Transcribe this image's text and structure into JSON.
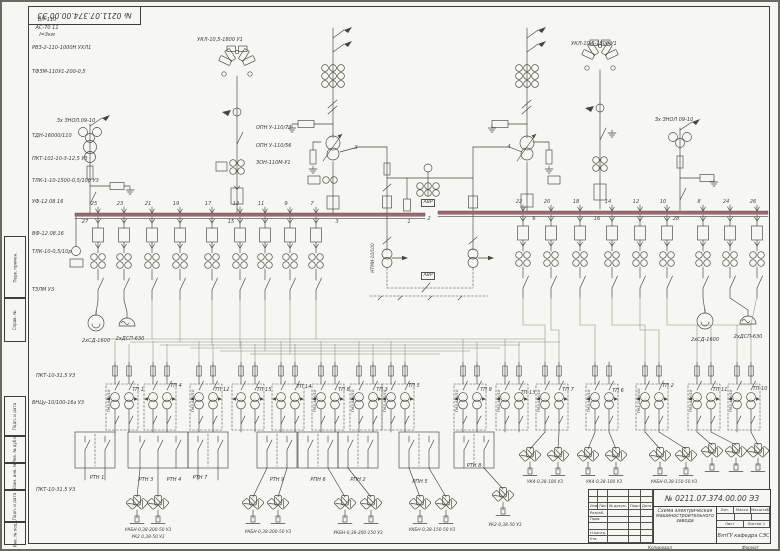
{
  "sheet": {
    "corner_stamp": "№ 0211.07.374.00.00 ЭЗ",
    "margin_labels": [
      {
        "t": "Перв. примен.",
        "y": 236,
        "h": 62
      },
      {
        "t": "Справ. №",
        "y": 298,
        "h": 44
      },
      {
        "t": "Подп. и дата",
        "y": 396,
        "h": 40
      },
      {
        "t": "Инв. № дубл.",
        "y": 436,
        "h": 27
      },
      {
        "t": "Взам. инв. №",
        "y": 463,
        "h": 27
      },
      {
        "t": "Подп. и дата",
        "y": 490,
        "h": 32
      },
      {
        "t": "Инв. № подл.",
        "y": 522,
        "h": 23
      }
    ],
    "title_block": {
      "doc_number": "№ 0211.07.374.00.00 ЭЗ",
      "title": "Схема электрическая машиностроительного завода",
      "org": "ВятГУ кафедра СЭС",
      "header_cells": [
        "Изм.",
        "Лист",
        "№ докум.",
        "Подп.",
        "Дата"
      ],
      "row_labels": [
        "Разраб.",
        "Пров.",
        "",
        "Н.контр.",
        "Утв."
      ],
      "lit_label": "Лит.",
      "mass_label": "Масса",
      "scale_label": "Масштаб",
      "sheet_label": "Лист",
      "sheets_label": "Листов 1",
      "kopiroval": "Копировал",
      "format_label": "Формат"
    }
  },
  "colors": {
    "paper": "#f6f6f2",
    "ink": "#45453f",
    "bus": "#9d6874",
    "routing": "#8e8e86",
    "frame": "#3e3e3a"
  },
  "placed_labels": [
    {
      "t": "ВЛ-110",
      "x": 47,
      "y": 18,
      "a": "c"
    },
    {
      "t": "АС-70 11",
      "x": 47,
      "y": 25.5,
      "a": "c"
    },
    {
      "t": "l=3км",
      "x": 47,
      "y": 33,
      "a": "c"
    },
    {
      "t": "РВЗ-2-110-1000Н УХЛ1",
      "x": 32,
      "y": 46
    },
    {
      "t": "ТФЗМ-110У1-200-0,5",
      "x": 32,
      "y": 70
    },
    {
      "t": "УКЛ-10,5-1800 У1",
      "x": 220,
      "y": 38,
      "a": "c"
    },
    {
      "t": "УКЛ-10,5-1800 У1",
      "x": 594,
      "y": 42,
      "a": "c"
    },
    {
      "t": "Зх ЗНОЛ.09-10",
      "x": 76,
      "y": 119,
      "a": "c"
    },
    {
      "t": "ТДН-16000/110",
      "x": 32,
      "y": 134
    },
    {
      "t": "ПКТ-101-10-3-12,5 У3",
      "x": 32,
      "y": 157
    },
    {
      "t": "ТЛК-1-10-1500-0,5/10р У3",
      "x": 32,
      "y": 179
    },
    {
      "t": "УФ-12.08.16",
      "x": 32,
      "y": 200
    },
    {
      "t": "ВФ-12.08.16",
      "x": 32,
      "y": 232
    },
    {
      "t": "ТЛК-10-0,5/10р",
      "x": 32,
      "y": 250
    },
    {
      "t": "ТЗЛМ У3",
      "x": 32,
      "y": 288
    },
    {
      "t": "ОПН У-110/73",
      "x": 256,
      "y": 126
    },
    {
      "t": "ОПН У-110/56",
      "x": 256,
      "y": 144
    },
    {
      "t": "ЗОН-110М-У1",
      "x": 256,
      "y": 161
    },
    {
      "t": "Зх ЗНОЛ 09-10",
      "x": 674,
      "y": 118,
      "a": "c"
    },
    {
      "t": "2хСД-1600",
      "x": 96,
      "y": 339,
      "a": "c"
    },
    {
      "t": "2хДСП-630",
      "x": 130,
      "y": 337,
      "a": "c"
    },
    {
      "t": "2хСД-1600",
      "x": 705,
      "y": 338,
      "a": "c"
    },
    {
      "t": "2хДСП-630",
      "x": 748,
      "y": 335,
      "a": "c"
    },
    {
      "t": "ПКТ-10-31,5 У3",
      "x": 36,
      "y": 374
    },
    {
      "t": "ВНЦу-10/100-16з У3",
      "x": 32,
      "y": 401
    },
    {
      "t": "ПКТ-10-31,5 У3",
      "x": 36,
      "y": 488
    },
    {
      "t": "АВР",
      "x": 428,
      "y": 199,
      "a": "c",
      "cls": "box",
      "n": "avr-box"
    },
    {
      "t": "АВР",
      "x": 428,
      "y": 272,
      "a": "c",
      "cls": "box",
      "n": "avr-box"
    },
    {
      "t": "НТМИ-10/100",
      "x": 374,
      "y": 258,
      "r": -90,
      "cls": "small"
    },
    {
      "t": "25",
      "x": 94,
      "y": 202,
      "a": "c",
      "cls": "num",
      "n": "feeder-number"
    },
    {
      "t": "23",
      "x": 120,
      "y": 202,
      "a": "c",
      "cls": "num",
      "n": "feeder-number"
    },
    {
      "t": "21",
      "x": 148,
      "y": 202,
      "a": "c",
      "cls": "num",
      "n": "feeder-number"
    },
    {
      "t": "19",
      "x": 176,
      "y": 202,
      "a": "c",
      "cls": "num",
      "n": "feeder-number"
    },
    {
      "t": "17",
      "x": 208,
      "y": 202,
      "a": "c",
      "cls": "num",
      "n": "feeder-number"
    },
    {
      "t": "13",
      "x": 236,
      "y": 202,
      "a": "c",
      "cls": "num",
      "n": "feeder-number"
    },
    {
      "t": "11",
      "x": 261,
      "y": 202,
      "a": "c",
      "cls": "num",
      "n": "feeder-number"
    },
    {
      "t": "9",
      "x": 286,
      "y": 202,
      "a": "c",
      "cls": "num",
      "n": "feeder-number"
    },
    {
      "t": "7",
      "x": 312,
      "y": 202,
      "a": "c",
      "cls": "num",
      "n": "feeder-number"
    },
    {
      "t": "27",
      "x": 85,
      "y": 220,
      "a": "c",
      "cls": "num",
      "n": "feeder-number"
    },
    {
      "t": "15",
      "x": 231,
      "y": 220,
      "a": "c",
      "cls": "num",
      "n": "feeder-number"
    },
    {
      "t": "3",
      "x": 337,
      "y": 220,
      "a": "c",
      "cls": "num",
      "n": "feeder-number"
    },
    {
      "t": "1",
      "x": 409,
      "y": 220,
      "a": "c",
      "cls": "num",
      "n": "section-number"
    },
    {
      "t": "22",
      "x": 519,
      "y": 200,
      "a": "c",
      "cls": "num",
      "n": "feeder-number"
    },
    {
      "t": "20",
      "x": 547,
      "y": 200,
      "a": "c",
      "cls": "num",
      "n": "feeder-number"
    },
    {
      "t": "18",
      "x": 576,
      "y": 200,
      "a": "c",
      "cls": "num",
      "n": "feeder-number"
    },
    {
      "t": "14",
      "x": 608,
      "y": 200,
      "a": "c",
      "cls": "num",
      "n": "feeder-number"
    },
    {
      "t": "12",
      "x": 636,
      "y": 200,
      "a": "c",
      "cls": "num",
      "n": "feeder-number"
    },
    {
      "t": "10",
      "x": 663,
      "y": 200,
      "a": "c",
      "cls": "num",
      "n": "feeder-number"
    },
    {
      "t": "8",
      "x": 699,
      "y": 200,
      "a": "c",
      "cls": "num",
      "n": "feeder-number"
    },
    {
      "t": "24",
      "x": 726,
      "y": 200,
      "a": "c",
      "cls": "num",
      "n": "feeder-number"
    },
    {
      "t": "26",
      "x": 753,
      "y": 200,
      "a": "c",
      "cls": "num",
      "n": "feeder-number"
    },
    {
      "t": "2",
      "x": 429,
      "y": 217,
      "a": "c",
      "cls": "num",
      "n": "section-number"
    },
    {
      "t": "6",
      "x": 534,
      "y": 217,
      "a": "c",
      "cls": "num",
      "n": "feeder-number"
    },
    {
      "t": "16",
      "x": 597,
      "y": 217,
      "a": "c",
      "cls": "num",
      "n": "feeder-number"
    },
    {
      "t": "28",
      "x": 676,
      "y": 217,
      "a": "c",
      "cls": "num",
      "n": "feeder-number"
    },
    {
      "t": "3",
      "x": 356,
      "y": 146,
      "a": "c",
      "cls": "num",
      "n": "line-number"
    },
    {
      "t": "4",
      "x": 509,
      "y": 145,
      "a": "c",
      "cls": "num",
      "n": "line-number"
    },
    {
      "t": "ТП 1",
      "x": 138,
      "y": 388,
      "a": "c",
      "n": "tp-label"
    },
    {
      "t": "ТП 4",
      "x": 176,
      "y": 384,
      "a": "c",
      "n": "tp-label"
    },
    {
      "t": "ТП 12",
      "x": 222,
      "y": 388,
      "a": "c",
      "n": "tp-label"
    },
    {
      "t": "ТП 15",
      "x": 264,
      "y": 388,
      "a": "c",
      "n": "tp-label"
    },
    {
      "t": "ТП 14",
      "x": 304,
      "y": 385,
      "a": "c",
      "n": "tp-label"
    },
    {
      "t": "ТП 8",
      "x": 344,
      "y": 388,
      "a": "c",
      "n": "tp-label"
    },
    {
      "t": "ТП 3",
      "x": 382,
      "y": 388,
      "a": "c",
      "n": "tp-label"
    },
    {
      "t": "ТП 5",
      "x": 414,
      "y": 384,
      "a": "c",
      "n": "tp-label"
    },
    {
      "t": "ТП 9",
      "x": 486,
      "y": 388,
      "a": "c",
      "n": "tp-label"
    },
    {
      "t": "ТП 13",
      "x": 528,
      "y": 391,
      "a": "c",
      "n": "tp-label"
    },
    {
      "t": "ТП 7",
      "x": 568,
      "y": 388,
      "a": "c",
      "n": "tp-label"
    },
    {
      "t": "ТП 6",
      "x": 618,
      "y": 389,
      "a": "c",
      "n": "tp-label"
    },
    {
      "t": "ТП 2",
      "x": 668,
      "y": 384,
      "a": "c",
      "n": "tp-label"
    },
    {
      "t": "ТП 11",
      "x": 720,
      "y": 388,
      "a": "c",
      "n": "tp-label"
    },
    {
      "t": "ТП 10",
      "x": 760,
      "y": 387,
      "a": "c",
      "n": "tp-label"
    },
    {
      "t": "РТН 1",
      "x": 97,
      "y": 476,
      "a": "c",
      "n": "rtn-label"
    },
    {
      "t": "РТН 3",
      "x": 146,
      "y": 478,
      "a": "c",
      "n": "rtn-label"
    },
    {
      "t": "РТН 4",
      "x": 174,
      "y": 478,
      "a": "c",
      "n": "rtn-label"
    },
    {
      "t": "РТН 7",
      "x": 200,
      "y": 476,
      "a": "c",
      "n": "rtn-label"
    },
    {
      "t": "РТН 9",
      "x": 277,
      "y": 478,
      "a": "c",
      "n": "rtn-label"
    },
    {
      "t": "РПН 6",
      "x": 318,
      "y": 478,
      "a": "c",
      "n": "rtn-label"
    },
    {
      "t": "РПН 2",
      "x": 358,
      "y": 478,
      "a": "c",
      "n": "rtn-label"
    },
    {
      "t": "РПН 5",
      "x": 420,
      "y": 480,
      "a": "c",
      "n": "rtn-label"
    },
    {
      "t": "РТН 8",
      "x": 474,
      "y": 464,
      "a": "c",
      "n": "rtn-label"
    },
    {
      "t": "УКБН-0,38-200-50 У3",
      "x": 148,
      "y": 529,
      "a": "c",
      "cls": "small",
      "n": "capacitor-label"
    },
    {
      "t": "УК2 0,38-50 У3",
      "x": 148,
      "y": 536,
      "a": "c",
      "cls": "small",
      "n": "capacitor-label"
    },
    {
      "t": "УКБН-0,38-200-50 У3",
      "x": 268,
      "y": 531,
      "a": "c",
      "cls": "small",
      "n": "capacitor-label"
    },
    {
      "t": "УКБН-0,38-200-150 У3",
      "x": 358,
      "y": 532,
      "a": "c",
      "cls": "small",
      "n": "capacitor-label"
    },
    {
      "t": "УКБН-0,38-150-50 У3",
      "x": 432,
      "y": 529,
      "a": "c",
      "cls": "small",
      "n": "capacitor-label"
    },
    {
      "t": "УК2-0,38-50 У3",
      "x": 505,
      "y": 524,
      "a": "c",
      "cls": "small",
      "n": "capacitor-label"
    },
    {
      "t": "УК4-0,38-100 У3",
      "x": 545,
      "y": 481,
      "a": "c",
      "cls": "small",
      "n": "capacitor-label"
    },
    {
      "t": "УК4-0,38-100 У3",
      "x": 604,
      "y": 481,
      "a": "c",
      "cls": "small",
      "n": "capacitor-label"
    },
    {
      "t": "УКБН-0,38-150-50 У3",
      "x": 674,
      "y": 481,
      "a": "c",
      "cls": "small",
      "n": "capacitor-label"
    },
    {
      "t": "ТМЗ-630/10",
      "x": 109,
      "y": 401,
      "r": -90,
      "cls": "tiny",
      "n": "transformer-label"
    },
    {
      "t": "ТМЗ-630/10",
      "x": 193,
      "y": 401,
      "r": -90,
      "cls": "tiny",
      "n": "transformer-label"
    },
    {
      "t": "ТМЗ-400/10",
      "x": 315,
      "y": 401,
      "r": -90,
      "cls": "tiny",
      "n": "transformer-label"
    },
    {
      "t": "ТМЗ-630/10",
      "x": 353,
      "y": 401,
      "r": -90,
      "cls": "tiny",
      "n": "transformer-label"
    },
    {
      "t": "ТМЗ-400/10",
      "x": 385,
      "y": 401,
      "r": -90,
      "cls": "tiny",
      "n": "transformer-label"
    },
    {
      "t": "ТМЗ-630/10",
      "x": 457,
      "y": 401,
      "r": -90,
      "cls": "tiny",
      "n": "transformer-label"
    },
    {
      "t": "ТМЗ-400/10",
      "x": 499,
      "y": 401,
      "r": -90,
      "cls": "tiny",
      "n": "transformer-label"
    },
    {
      "t": "ТМЗ-630/10",
      "x": 539,
      "y": 401,
      "r": -90,
      "cls": "tiny",
      "n": "transformer-label"
    },
    {
      "t": "ТМЗ-400/10",
      "x": 589,
      "y": 401,
      "r": -90,
      "cls": "tiny",
      "n": "transformer-label"
    },
    {
      "t": "ТМЗ-1000/10",
      "x": 639,
      "y": 401,
      "r": -90,
      "cls": "tiny",
      "n": "transformer-label"
    },
    {
      "t": "ТМЗ-630/10",
      "x": 691,
      "y": 401,
      "r": -90,
      "cls": "tiny",
      "n": "transformer-label"
    },
    {
      "t": "ТМЗ-400/10",
      "x": 731,
      "y": 401,
      "r": -90,
      "cls": "tiny",
      "n": "transformer-label"
    }
  ]
}
